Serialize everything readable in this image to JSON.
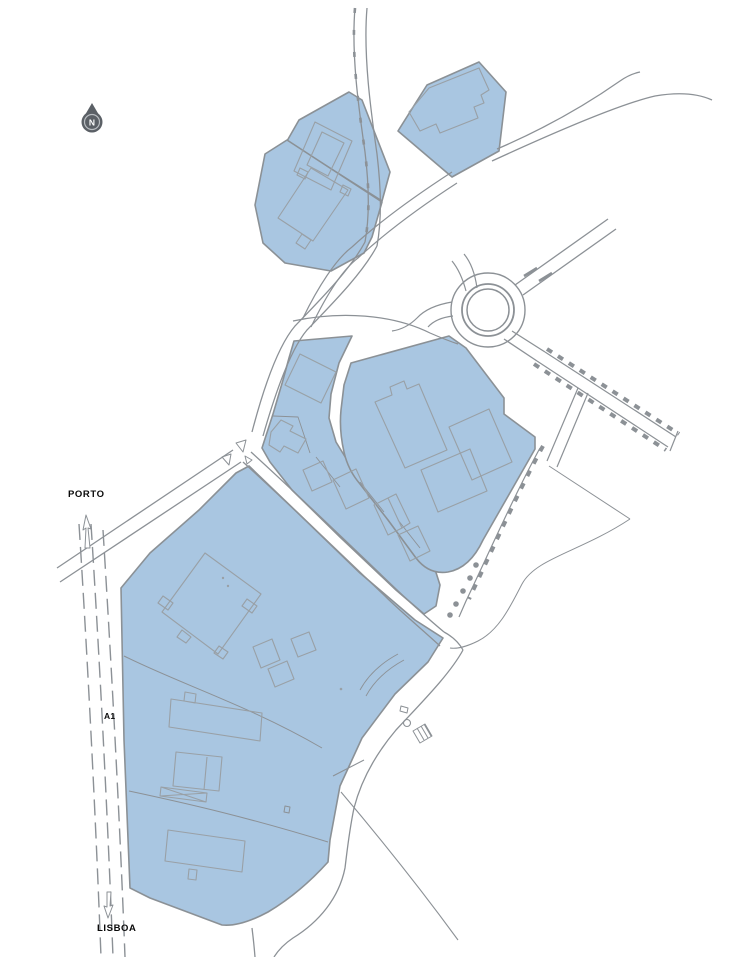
{
  "map": {
    "type": "site-plan",
    "labels": {
      "north_mark": "N",
      "dest_north": "PORTO",
      "road_ref": "A1",
      "dest_south": "LISBOA"
    },
    "colors": {
      "background": "#ffffff",
      "parcel_fill": "#a9c6e1",
      "parcel_stroke": "#8b9196",
      "building_stroke": "#99a0a6",
      "road_stroke": "#8c9196",
      "mark_fill": "#8c9196",
      "north_symbol": "#5b6066",
      "label_color": "#0a0a0a"
    },
    "layers": [
      {
        "name": "parcels",
        "stroke": "#8b9196",
        "fill": "#a9c6e1",
        "width": 1.6,
        "paths": [
          {
            "name": "parcel-north-a",
            "d": "M287,141 L299,120 L349,92 L362,100 L390,172 L382,201 Z"
          },
          {
            "name": "parcel-north-b",
            "d": "M265,154 L287,140 L382,202 L372,237 L364,253 L331,271 L285,263 L263,243 L255,205 Z"
          },
          {
            "name": "parcel-north-c",
            "d": "M398,131 L427,85 L479,62 L506,92 L499,151 L452,177 Z"
          },
          {
            "name": "parcel-mid-west",
            "d": "M294,341 L352,336 L339,363 L331,394 L329,418 L336,442 L352,468 L378,496 L410,530 L432,560 L440,585 L436,606 L424,614 L396,590 L340,537 L292,490 L270,462 L262,448 L273,414 L283,380 L289,358 Z"
          },
          {
            "name": "parcel-mid-east",
            "d": "M351,363 L449,336 L466,348 L504,398 L504,414 L535,437 L535,449 L483,540 Q470,568 448,572 Q429,575 416,558 L388,520 L360,484 Q348,470 344,452 Q339,430 341,410 L344,385 Z"
          },
          {
            "name": "parcel-south",
            "d": "M121,588 L150,553 L199,510 L236,473 L249,466 L300,515 L360,573 L415,620 L443,638 L428,662 L395,694 L362,738 L340,786 L330,840 L328,862 Q300,893 268,912 Q240,927 222,925 L150,898 L130,888 L124,740 Z"
          }
        ]
      },
      {
        "name": "roads",
        "stroke": "#8c9196",
        "fill": "none",
        "width": 1.3,
        "paths": [
          {
            "name": "road-main-north-west-line",
            "d": "M355,8 C351,55 359,110 365,152 C369,185 370,215 365,242"
          },
          {
            "name": "road-main-north-west-dashes",
            "d": "M355,8 C351,55 359,110 365,152 C369,185 370,215 365,242",
            "w": 2.6,
            "dash": "5 17"
          },
          {
            "name": "road-main-north-east-line",
            "d": "M367,8 C363,55 371,112 377,154 C381,188 382,218 377,246"
          },
          {
            "name": "road-main-lower-west-line",
            "d": "M365,242 C350,270 320,300 295,326 C278,346 263,390 252,432"
          },
          {
            "name": "road-main-lower-east-line",
            "d": "M377,246 C362,274 332,304 307,330 C290,350 275,394 263,436"
          },
          {
            "name": "road-c-south-north-line",
            "d": "M452,172 C415,196 378,223 352,247 C336,259 318,287 303,318",
            "w": 1.2
          },
          {
            "name": "road-c-south-south-line",
            "d": "M457,183 C420,207 384,234 358,258 C342,270 325,298 311,327",
            "w": 1.2
          },
          {
            "name": "road-northeast-upper-line",
            "d": "M497,149 C560,122 600,95 620,81 Q630,74 640,72"
          },
          {
            "name": "road-northeast-lower-line",
            "d": "M492,161 C555,132 620,104 655,96 Q690,90 712,100"
          },
          {
            "name": "road-junction-sw-north-line",
            "d": "M233,450 L57,568"
          },
          {
            "name": "road-junction-sw-south-line",
            "d": "M241,462 L60,582"
          },
          {
            "name": "avenue-northeast-line",
            "d": "M251,452 C295,492 345,540 396,589 C415,607 432,622 444,632"
          },
          {
            "name": "avenue-southwest-line",
            "d": "M243,462 C287,502 337,550 388,599 C407,617 426,633 440,646"
          },
          {
            "name": "avenue-end-curve",
            "d": "M444,632 Q457,639 463,650"
          },
          {
            "name": "road-south-east-line",
            "d": "M463,650 C450,674 422,702 396,730 C374,756 361,781 354,808 C349,832 347,852 345,868 C339,898 319,922 293,938 Q281,946 274,957"
          },
          {
            "name": "road-south-west-tail",
            "d": "M252,928 Q254,944 255,957"
          },
          {
            "name": "path-branch-southeast",
            "d": "M341,792 C380,838 420,888 458,940",
            "w": 1.1
          },
          {
            "name": "path-branch-northeast-g",
            "d": "M333,776 L364,760",
            "w": 1.1
          },
          {
            "name": "roundabout-north-stub-a",
            "d": "M466,291 Q461,272 452,261",
            "w": 1.2
          },
          {
            "name": "roundabout-north-stub-b",
            "d": "M477,288 Q474,266 464,254",
            "w": 1.2
          },
          {
            "name": "roundabout-ne-spoke-a",
            "d": "M515,285 L608,219"
          },
          {
            "name": "roundabout-ne-spoke-b",
            "d": "M523,295 L616,229"
          },
          {
            "name": "roundabout-se-spoke-a",
            "d": "M512,331 L545,352"
          },
          {
            "name": "roundabout-se-spoke-b",
            "d": "M504,339 L537,361"
          },
          {
            "name": "roundabout-west-hook-a",
            "d": "M452,302 Q428,306 417,318 Q406,329 392,331",
            "w": 1.2
          },
          {
            "name": "roundabout-west-hook-b",
            "d": "M453,316 Q436,318 428,327",
            "w": 1.2
          },
          {
            "name": "road-top-loop-north-line",
            "d": "M293,321 C340,311 392,314 430,333 Q446,340 458,344",
            "w": 1.2
          },
          {
            "name": "tree-road-se-north-line",
            "d": "M545,352 L676,437",
            "w": 1.2
          },
          {
            "name": "tree-road-se-south-line",
            "d": "M537,361 L668,447",
            "w": 1.2
          },
          {
            "name": "tree-road-se-dashes-north",
            "d": "M547,349 L679,434",
            "w": 4,
            "dash": "6 7"
          },
          {
            "name": "tree-road-se-dashes-south",
            "d": "M534,364 L666,450",
            "w": 4,
            "dash": "6 7"
          },
          {
            "name": "tree-road-end-cap",
            "d": "M678,431 L670,451",
            "w": 1.2
          },
          {
            "name": "tree-branch-line",
            "d": "M540,448 C516,492 492,546 466,601 L459,617",
            "w": 1.2
          },
          {
            "name": "tree-branch-dashes",
            "d": "M543,446 C519,490 495,544 469,599",
            "w": 4,
            "dash": "6 8"
          },
          {
            "name": "road-branch-south-a",
            "d": "M578,388 L547,461",
            "w": 1.2
          },
          {
            "name": "road-branch-south-b",
            "d": "M588,393 L557,467",
            "w": 1.2
          },
          {
            "name": "field-line-east",
            "d": "M549,466 L630,519",
            "w": 1
          },
          {
            "name": "field-curve-south",
            "d": "M630,519 C580,552 536,558 522,584 C512,603 500,630 478,641 C466,647 456,649 450,648",
            "w": 1
          },
          {
            "name": "a1-lane-line-1",
            "d": "M79,524 C87,650 95,800 101,957",
            "w": 1.4,
            "dash": "16 7"
          },
          {
            "name": "a1-lane-line-2",
            "d": "M91,524 C99,650 107,800 113,957",
            "w": 1.4,
            "dash": "16 7"
          },
          {
            "name": "a1-lane-line-3",
            "d": "M103,530 C111,660 119,800 125,957",
            "w": 1.4,
            "dash": "16 7"
          },
          {
            "name": "parcel-south-division-1",
            "d": "M124,656 C180,684 250,706 322,748",
            "w": 1
          },
          {
            "name": "parcel-south-division-2",
            "d": "M129,791 C190,804 250,818 328,842",
            "w": 1
          },
          {
            "name": "parcel-south-inner-curve-a",
            "d": "M398,654 Q372,668 360,690",
            "w": 0.9
          },
          {
            "name": "parcel-south-inner-curve-b",
            "d": "M404,660 Q378,674 366,696",
            "w": 0.9
          },
          {
            "name": "parcel-mid-division-1",
            "d": "M273,416 L298,417 L310,453",
            "w": 0.9
          },
          {
            "name": "parcel-strip-division-1",
            "d": "M316,457 L340,487",
            "w": 0.9
          },
          {
            "name": "parcel-strip-division-2",
            "d": "M360,482 L384,512",
            "w": 0.9
          },
          {
            "name": "parcel-strip-division-3",
            "d": "M398,520 L420,548",
            "w": 0.9
          }
        ],
        "circles": [
          {
            "name": "roundabout-outer-circle",
            "cx": 488,
            "cy": 310,
            "r": 37,
            "w": 1.4
          },
          {
            "name": "roundabout-mid-circle",
            "cx": 488,
            "cy": 310,
            "r": 26,
            "w": 1.8
          },
          {
            "name": "roundabout-inner-circle",
            "cx": 488,
            "cy": 310,
            "r": 21,
            "w": 1.5
          }
        ]
      },
      {
        "name": "buildings",
        "stroke": "#99a0a6",
        "fill": "none",
        "width": 1.1,
        "paths": [
          {
            "name": "building-north-a",
            "d": "M315,122 L352,141 L331,190 L294,171 Z M322,132 L344,143 L328,176 L307,165 Z M300,168 L308,172 L305,179 L297,175 Z M343,185 L351,189 L348,196 L340,192 Z"
          },
          {
            "name": "building-north-b",
            "d": "M311,168 L348,190 L313,241 L278,218 Z M302,234 L311,240 L305,249 L296,243 Z"
          },
          {
            "name": "building-north-c",
            "d": "M409,112 L429,88 L479,68 L489,90 L481,95 L484,103 L474,107 L478,118 L440,133 L436,124 L420,131 Z"
          },
          {
            "name": "building-mid-west-main",
            "d": "M300,354 L336,372 L321,403 L285,385 Z"
          },
          {
            "name": "building-mid-west-small",
            "d": "M271,432 L281,420 L293,426 L290,431 L306,439 L298,453 L284,446 L280,452 L269,445 Z"
          },
          {
            "name": "building-mid-east-1",
            "d": "M375,402 L392,395 L390,387 L404,381 L407,389 L419,384 L447,450 L405,468 Z"
          },
          {
            "name": "building-mid-east-2",
            "d": "M449,427 L489,409 L512,462 L472,480 Z"
          },
          {
            "name": "building-mid-east-3",
            "d": "M421,470 L470,449 L487,491 L438,512 Z"
          },
          {
            "name": "building-strip-1",
            "d": "M303,470 L323,461 L332,482 L312,491 Z"
          },
          {
            "name": "building-strip-2",
            "d": "M333,480 L356,469 L369,498 L346,509 Z"
          },
          {
            "name": "building-strip-3",
            "d": "M374,505 L388,498 L402,528 L388,535 Z M388,498 L396,494 L410,523 L402,528 Z"
          },
          {
            "name": "building-strip-4",
            "d": "M398,535 L418,526 L430,551 L410,561 Z"
          },
          {
            "name": "building-south-big-square",
            "d": "M205,553 L261,594 L218,654 L162,612 Z M163,596 L173,603 L168,610 L158,603 Z M247,599 L257,606 L252,613 L242,606 Z M182,630 L191,637 L186,643 L177,637 Z M219,646 L228,652 L223,659 L214,653 Z"
          },
          {
            "name": "building-south-small-group",
            "d": "M253,647 L272,639 L280,660 L261,668 Z M268,669 L287,661 L294,679 L275,687 Z M291,639 L309,632 L316,650 L298,657 Z"
          },
          {
            "name": "building-south-long-1",
            "d": "M171,699 L262,713 L260,741 L169,727 Z M185,692 L196,694 L195,703 L184,701 Z"
          },
          {
            "name": "building-south-square-2",
            "d": "M176,752 L222,757 L219,791 L173,786 Z M207,757 L204,790 M161,787 L207,793 L206,802 L160,796 Z M161,787 L206,802 M160,796 L207,793"
          },
          {
            "name": "building-south-long-2",
            "d": "M168,830 L245,841 L242,872 L165,861 Z M189,869 L197,870 L196,880 L188,879 Z"
          }
        ]
      },
      {
        "name": "marks",
        "stroke": "#8c9196",
        "fill": "none",
        "width": 1,
        "paths": [
          {
            "name": "junction-island-1",
            "d": "M236,443 L246,440 L243,452 Z"
          },
          {
            "name": "junction-island-2",
            "d": "M222,457 L231,454 L229,465 Z"
          },
          {
            "name": "junction-island-3",
            "d": "M245,456 L252,460 L247,464 Z"
          },
          {
            "name": "roundabout-hatch-marks",
            "d": "M524,276 L537,268 M539,281 L552,273",
            "w": 2.5
          },
          {
            "name": "symbol-small-dash",
            "d": "M401,706 L408,708 L407,713 L400,711 Z"
          },
          {
            "name": "symbol-hatched-rect",
            "d": "M413,731 L425,724 L432,736 L420,743 Z M417,728 L424,740 M421,726 L428,738 M424,724 L431,736"
          },
          {
            "name": "symbol-small-rect-south",
            "d": "M285,806 L290,807 L289,813 L284,812 Z"
          },
          {
            "name": "arrow-north-porto",
            "d": "M86,515 L91,529 L88,528 L90,548 L85,548 L86,528 L83,530 Z",
            "fill": "#ffffff"
          },
          {
            "name": "arrow-south-lisboa",
            "d": "M107,892 L111,892 L110,906 L113,905 L108,918 L104,906 L107,907 Z",
            "fill": "#ffffff"
          }
        ],
        "circles": [
          {
            "name": "symbol-small-circle",
            "cx": 407,
            "cy": 723,
            "r": 3.5,
            "w": 1.1
          },
          {
            "name": "tree-dot-1",
            "cx": 476,
            "cy": 565,
            "r": 2.8,
            "fill": "#8c9196"
          },
          {
            "name": "tree-dot-2",
            "cx": 470,
            "cy": 578,
            "r": 2.8,
            "fill": "#8c9196"
          },
          {
            "name": "tree-dot-3",
            "cx": 463,
            "cy": 591,
            "r": 2.8,
            "fill": "#8c9196"
          },
          {
            "name": "tree-dot-4",
            "cx": 456,
            "cy": 604,
            "r": 2.8,
            "fill": "#8c9196"
          },
          {
            "name": "tree-dot-5",
            "cx": 450,
            "cy": 615,
            "r": 2.8,
            "fill": "#8c9196"
          },
          {
            "name": "parcel-south-dot-1",
            "cx": 223,
            "cy": 578,
            "r": 1.2,
            "fill": "#99a0a6"
          },
          {
            "name": "parcel-south-dot-2",
            "cx": 228,
            "cy": 586,
            "r": 1.2,
            "fill": "#99a0a6"
          },
          {
            "name": "parcel-south-dot-3",
            "cx": 341,
            "cy": 689,
            "r": 1.3,
            "fill": "#99a0a6"
          }
        ]
      }
    ]
  }
}
